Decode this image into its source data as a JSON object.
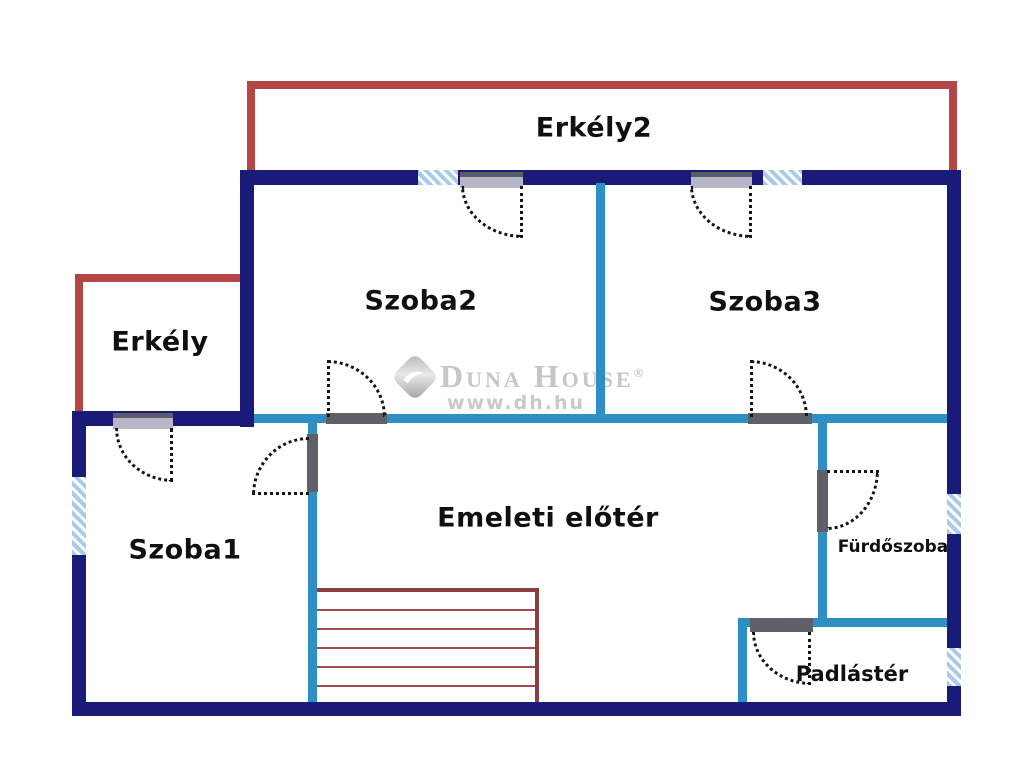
{
  "type": "floor-plan",
  "rooms": [
    {
      "name": "erkely2",
      "label": "Erkély2"
    },
    {
      "name": "szoba2",
      "label": "Szoba2"
    },
    {
      "name": "szoba3",
      "label": "Szoba3"
    },
    {
      "name": "erkely",
      "label": "Erkély"
    },
    {
      "name": "szoba1",
      "label": "Szoba1"
    },
    {
      "name": "emeleti-eloter",
      "label": "Emeleti előtér"
    },
    {
      "name": "furdoszoba",
      "label": "Fürdőszoba"
    },
    {
      "name": "padlaster",
      "label": "Padlástér"
    }
  ],
  "watermark": {
    "brand": "Duna House",
    "registered": "®",
    "url": "www.dh.hu"
  },
  "colors": {
    "exterior_wall": "#1a1a78",
    "interior_wall": "#2e8fc4",
    "balcony_wall": "#b34646",
    "stairs": "#a04c4c",
    "window_fill": "#a9cbe8",
    "door_sill_exterior": "#b7b7c8",
    "door_sill_interior": "#5f6068",
    "label_text": "#101010",
    "watermark_text": "#c6c6c6"
  }
}
